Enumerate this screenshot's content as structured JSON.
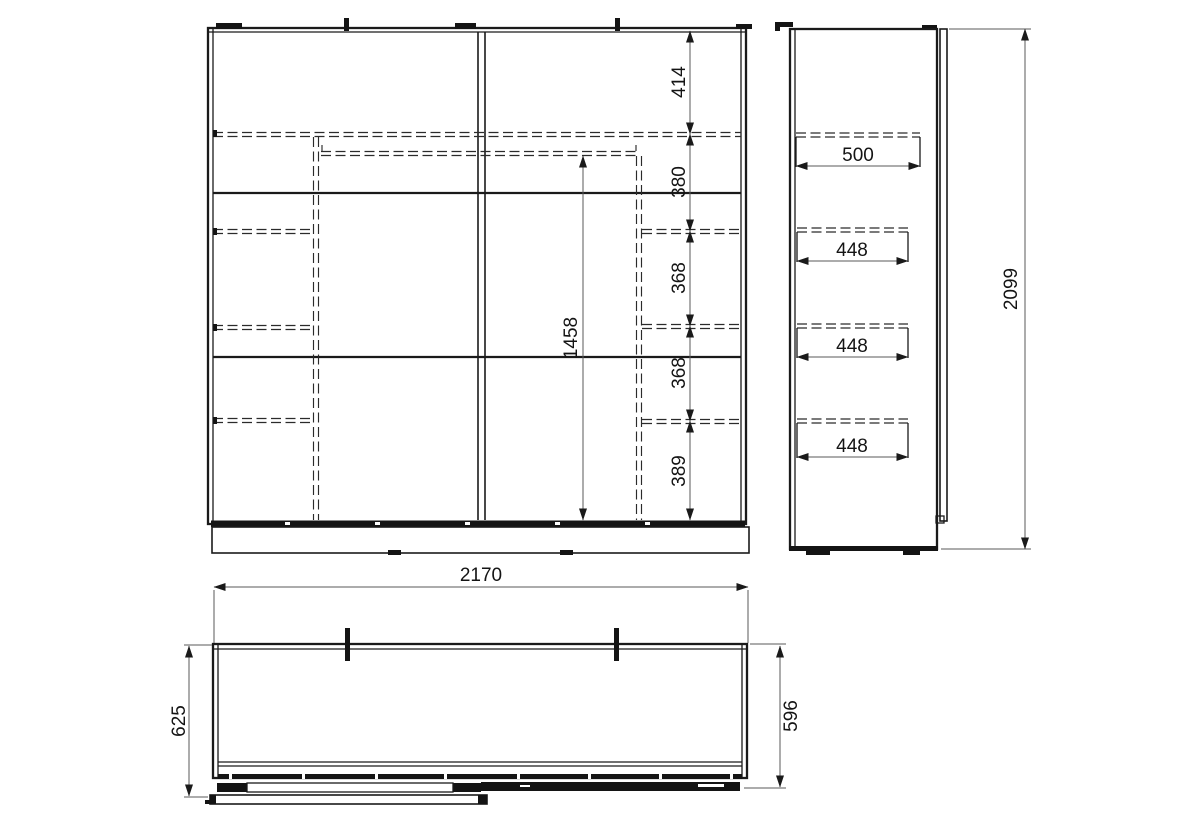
{
  "drawing": {
    "front_view": {
      "section_heights": [
        "414",
        "380",
        "368",
        "368",
        "389"
      ],
      "interior_height": "1458"
    },
    "side_view": {
      "top_shelf_depth": "500",
      "drawer_depths": [
        "448",
        "448",
        "448"
      ],
      "overall_height": "2099"
    },
    "top_view": {
      "overall_width": "2170",
      "depth_overall": "625",
      "depth_body": "596"
    }
  }
}
